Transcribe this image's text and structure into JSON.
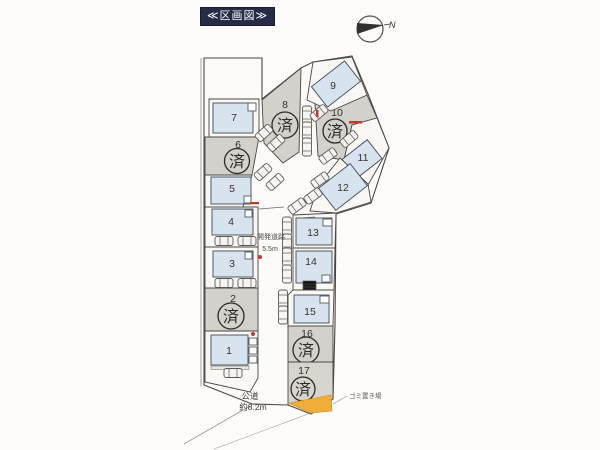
{
  "title": "≪区画図≫",
  "compass": {
    "label": "N"
  },
  "legend": {
    "sold_label": "済"
  },
  "roads": {
    "development": {
      "name": "開発道路",
      "width": "5.5m"
    },
    "public": {
      "name": "公道",
      "width": "約8.2m"
    }
  },
  "garbage": {
    "label": "ゴミ置き場"
  },
  "lots": [
    {
      "number": "1",
      "status": "house"
    },
    {
      "number": "2",
      "status": "sold"
    },
    {
      "number": "3",
      "status": "house"
    },
    {
      "number": "4",
      "status": "house"
    },
    {
      "number": "5",
      "status": "house"
    },
    {
      "number": "6",
      "status": "sold"
    },
    {
      "number": "7",
      "status": "house"
    },
    {
      "number": "8",
      "status": "sold"
    },
    {
      "number": "9",
      "status": "house"
    },
    {
      "number": "10",
      "status": "sold"
    },
    {
      "number": "11",
      "status": "house"
    },
    {
      "number": "12",
      "status": "house"
    },
    {
      "number": "13",
      "status": "house"
    },
    {
      "number": "14",
      "status": "house"
    },
    {
      "number": "15",
      "status": "house"
    },
    {
      "number": "16",
      "status": "sold"
    },
    {
      "number": "17",
      "status": "sold"
    }
  ],
  "colors": {
    "sold_fill": "#d2d1cc",
    "available_fill": "#f9f8f5",
    "house_fill": "#d7e4f0",
    "garbage_fill": "#f0ad3a",
    "title_bg": "#262b46",
    "accent_red": "#c83828"
  }
}
